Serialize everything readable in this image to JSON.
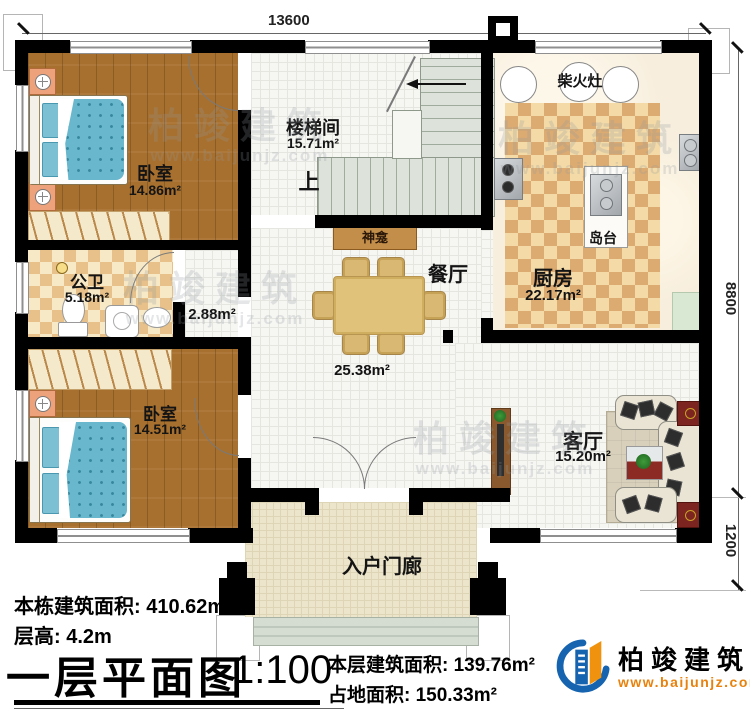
{
  "dims": {
    "top": "13600",
    "right_upper": "8800",
    "right_lower": "1200"
  },
  "rooms": {
    "bedroom1": {
      "name": "卧室",
      "area": "14.86m²"
    },
    "bedroom2": {
      "name": "卧室",
      "area": "14.51m²"
    },
    "stairwell": {
      "name": "楼梯间",
      "area": "15.71m²"
    },
    "bathroom": {
      "name": "公卫",
      "area": "5.18m²"
    },
    "hallway": {
      "area": "2.88m²"
    },
    "dining": {
      "name": "餐厅",
      "area": "25.38m²"
    },
    "kitchen": {
      "name": "厨房",
      "area": "22.17m²"
    },
    "living": {
      "name": "客厅",
      "area": "15.20m²"
    },
    "porch": {
      "name": "入户门廊"
    }
  },
  "features": {
    "wood_stove": "柴火灶",
    "island": "岛台",
    "shrine": "神龛",
    "stairs_up": "上"
  },
  "building_stats": {
    "total_area_label": "本栋建筑面积:",
    "total_area_value": "410.62m²",
    "floor_height_label": "层高:",
    "floor_height_value": "4.2m"
  },
  "title_block": {
    "title": "一层平面图",
    "scale": "1:100",
    "floor_area_label": "本层建筑面积:",
    "floor_area_value": "139.76m²",
    "footprint_label": "占地面积:",
    "footprint_value": "150.33m²"
  },
  "brand": {
    "name": "柏竣建筑",
    "website": "www.baijunjz.com"
  },
  "watermark": {
    "cn": "柏竣建筑",
    "en": "www.baijunjz.com"
  },
  "colors": {
    "wall": "#000000",
    "wood": "#a8702e",
    "accent_orange": "#e8820c",
    "brand_blue": "#1663b0"
  }
}
